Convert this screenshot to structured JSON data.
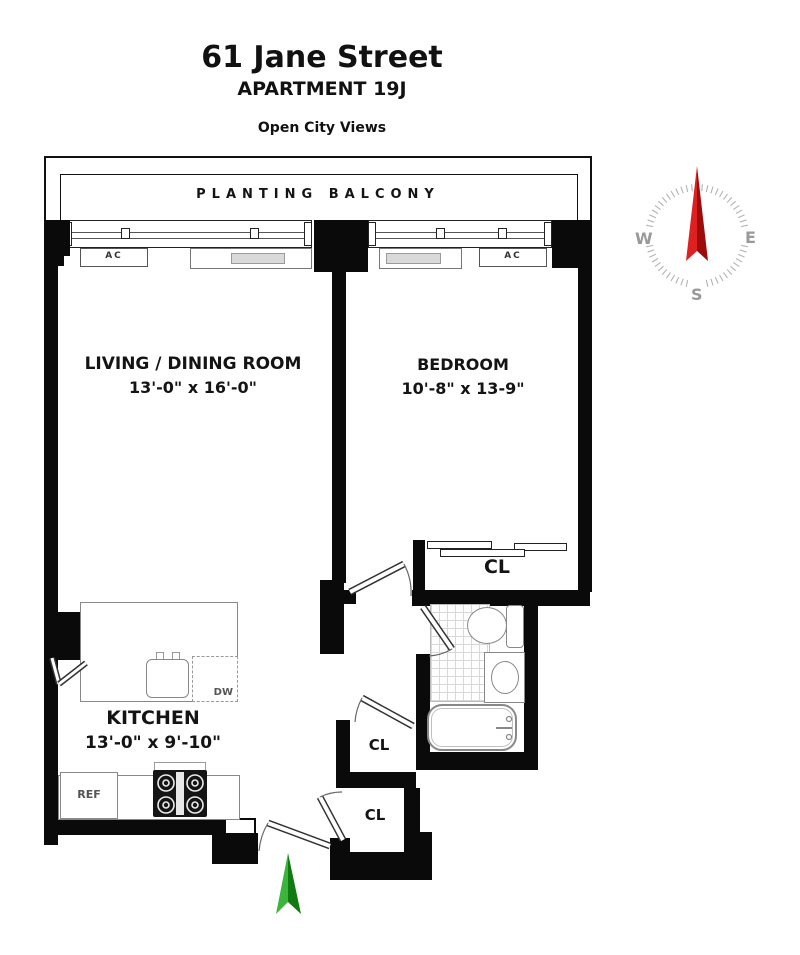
{
  "header": {
    "building": "61 Jane Street",
    "apartment": "APARTMENT 19J",
    "tagline": "Open City Views"
  },
  "balcony_label": "PLANTING BALCONY",
  "rooms": {
    "living": {
      "name": "LIVING / DINING ROOM",
      "dims": "13'-0\" x 16'-0\""
    },
    "bedroom": {
      "name": "BEDROOM",
      "dims": "10'-8\" x 13-9\""
    },
    "kitchen": {
      "name": "KITCHEN",
      "dims": "13'-0\" x 9'-10\""
    }
  },
  "closets": {
    "bedroom": "CL",
    "hall": "CL",
    "entry": "CL"
  },
  "appliances": {
    "ac_left": "AC",
    "ac_right": "AC",
    "dishwasher": "DW",
    "refrigerator": "REF"
  },
  "compass": {
    "west": "W",
    "east": "E",
    "south": "S",
    "needle_light": "#df2020",
    "needle_dark": "#9c0c0c",
    "tick_color": "#b3b3b3",
    "letter_color": "#999999"
  },
  "entry_arrow": {
    "light": "#3cb53c",
    "dark": "#117a11"
  }
}
